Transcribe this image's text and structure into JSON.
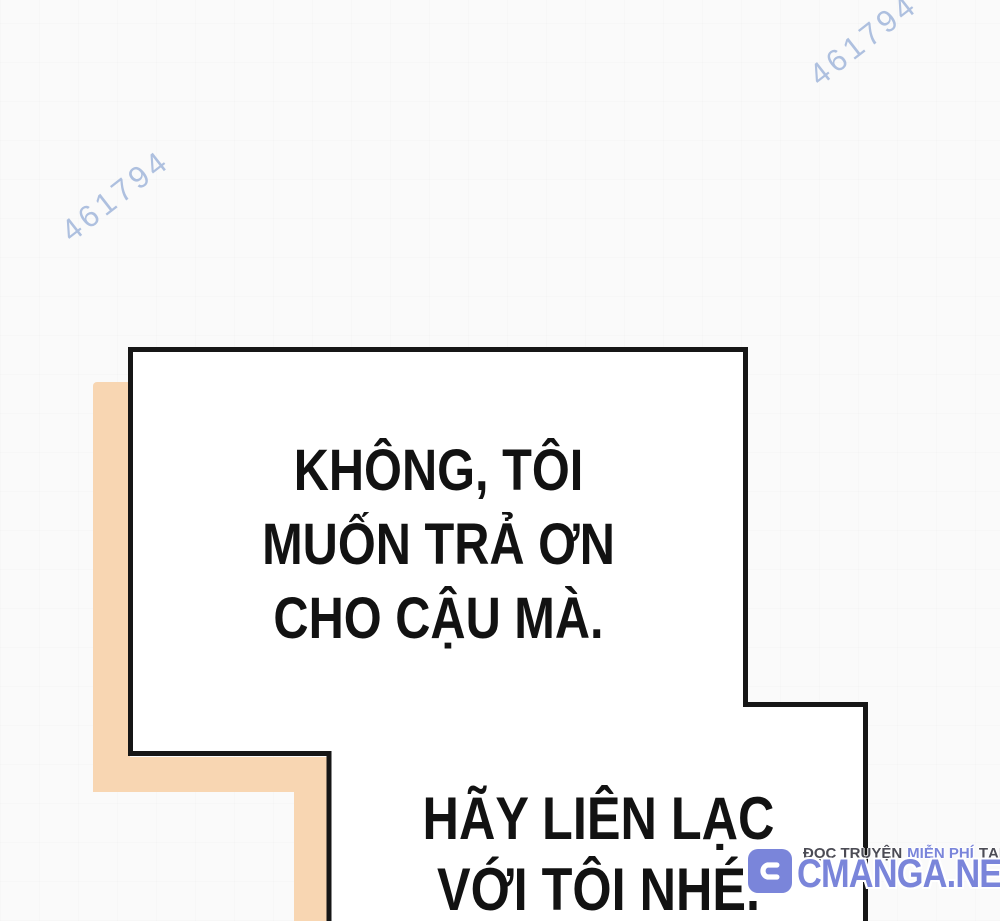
{
  "watermark": {
    "id_text": "461794",
    "color": "#a6badd"
  },
  "dialogue": {
    "bubble_no_repay": {
      "lines": [
        "KHÔNG, TÔI",
        "MUỐN TRẢ ƠN",
        "CHO CẬU MÀ."
      ]
    },
    "bubble_contact": {
      "lines": [
        "HÃY LIÊN LẠC",
        "VỚI TÔI NHÉ."
      ]
    }
  },
  "site_badge": {
    "icon_letter": "C",
    "tagline_dark_1": "ĐỌC TRUYỆN",
    "tagline_accent": "MIỄN PHÍ",
    "tagline_dark_2": "TẠI",
    "site_name": "CMANGA.NET"
  },
  "colors": {
    "background": "#fafafa",
    "panel_fill": "#ffffff",
    "panel_border": "#161616",
    "accent_peach": "#f8d6b2",
    "watermark_blue": "#a6badd",
    "brand_blue": "#7a85da",
    "tagline_dark": "#4c4c55",
    "text_black": "#121212"
  }
}
